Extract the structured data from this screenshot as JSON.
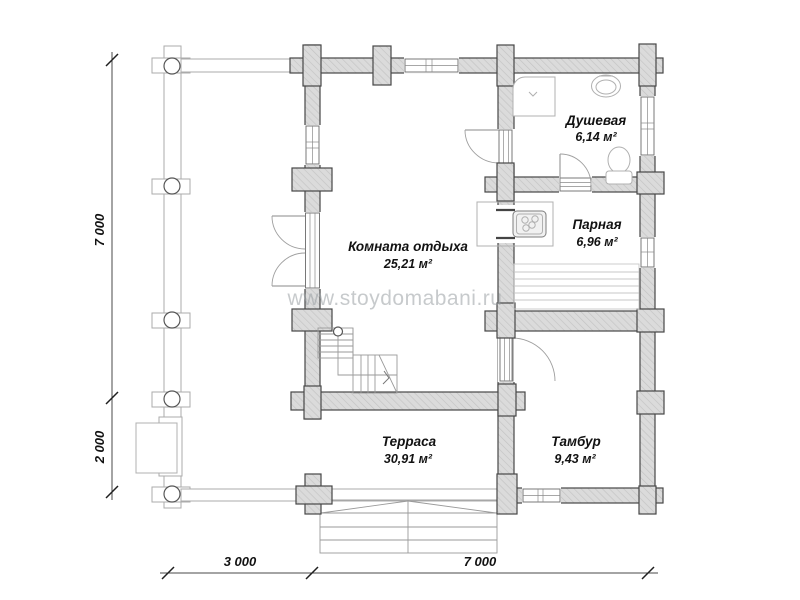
{
  "watermark": "www.stoydomabani.ru",
  "rooms": {
    "dushevaya": {
      "name": "Душевая",
      "area": "6,14 м²"
    },
    "parnaya": {
      "name": "Парная",
      "area": "6,96 м²"
    },
    "komnata": {
      "name": "Комната отдыха",
      "area": "25,21 м²"
    },
    "terrasa": {
      "name": "Терраса",
      "area": "30,91 м²"
    },
    "tambur": {
      "name": "Тамбур",
      "area": "9,43 м²"
    }
  },
  "dimensions": {
    "left_main": "7 000",
    "left_terrace": "2 000",
    "bottom_terrace": "3 000",
    "bottom_main": "7 000"
  }
}
